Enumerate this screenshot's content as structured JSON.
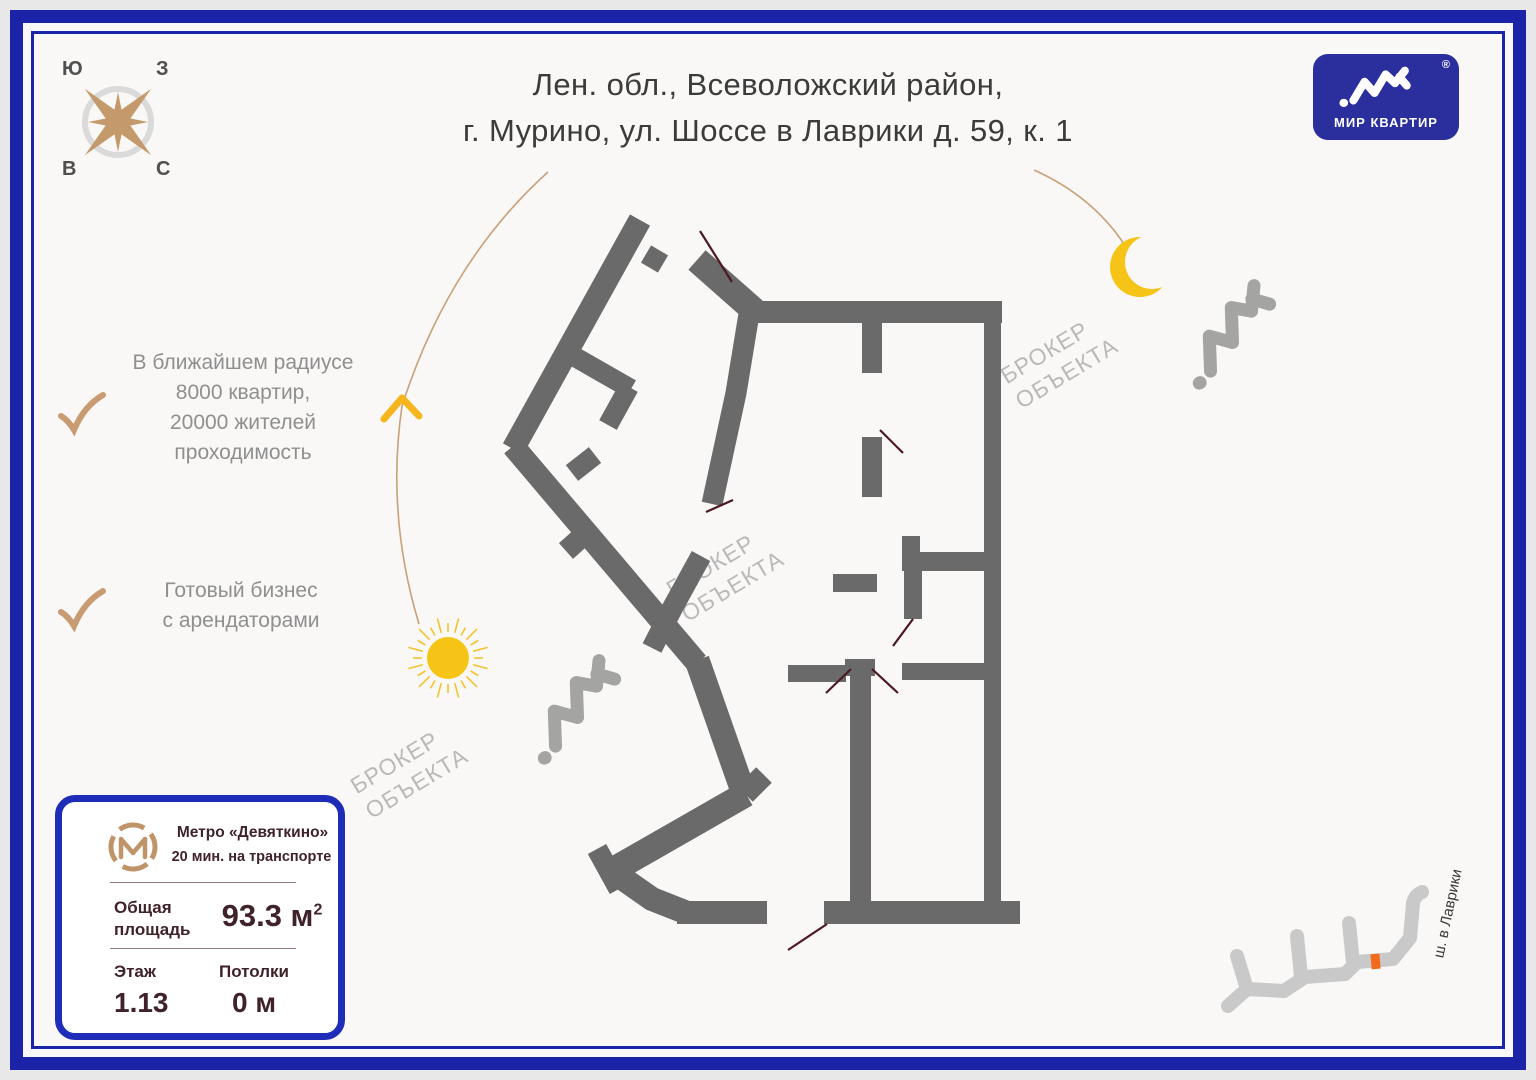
{
  "title": {
    "line1": "Лен. обл., Всеволожский район,",
    "line2": "г. Мурино, ул. Шоссе в Лаврики д. 59, к. 1"
  },
  "brand": {
    "name": "МИР КВАРТИР",
    "reg": "®"
  },
  "compass": {
    "top_left": "Ю",
    "top_right": "З",
    "bottom_left": "В",
    "bottom_right": "С"
  },
  "features": [
    {
      "lines": [
        "В ближайшем радиусе",
        "8000 квартир,",
        "20000 жителей",
        "проходимость"
      ]
    },
    {
      "lines": [
        "Готовый бизнес",
        "с арендаторами"
      ]
    }
  ],
  "watermark": {
    "line1": "БРОКЕР",
    "line2": "ОБЪЕКТА"
  },
  "info_card": {
    "metro": {
      "name": "Метро «Девяткино»",
      "time": "20 мин. на транспорте"
    },
    "area": {
      "label_line1": "Общая",
      "label_line2": "площадь",
      "value": "93.3 м",
      "sup": "2"
    },
    "floor": {
      "label": "Этаж",
      "value": "1.13"
    },
    "ceiling": {
      "label": "Потолки",
      "value": "0 м"
    }
  },
  "street": {
    "label": "ш. в Лаврики"
  },
  "colors": {
    "frame_blue": "#1b23a8",
    "brand_blue": "#2b2f9e",
    "card_border_blue": "#1e2cb8",
    "wall_gray": "#6a6a6a",
    "sun_yellow": "#f6c417",
    "accent_tan": "#c49a6c",
    "marker_orange": "#f26a1b",
    "card_text": "#40222a",
    "watermark_gray": "#b9b9b9",
    "street_gray": "#c9c9c9",
    "door_line": "#4c1822"
  }
}
